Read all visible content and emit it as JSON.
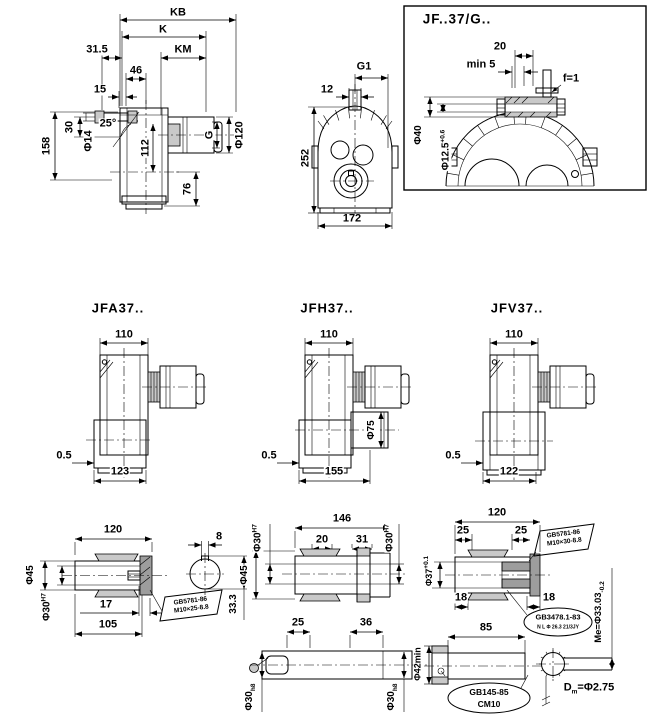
{
  "sheet": {
    "detail_box_title": "JF..37/G..",
    "top_side": {
      "kb": "KB",
      "k": "K",
      "km": "KM",
      "d315": "31.5",
      "d46": "46",
      "d15": "15",
      "a25": "25°",
      "phi14": "Φ14",
      "d30": "30",
      "d158": "158",
      "d112": "112",
      "d76": "76",
      "g": "G",
      "phi120": "Φ120"
    },
    "top_front": {
      "g1": "G1",
      "d12": "12",
      "d252": "252",
      "d172": "172"
    },
    "detail_box": {
      "d20": "20",
      "min5": "min 5",
      "f1": "f=1",
      "phi40": "Φ40",
      "phi125": "Φ12.5",
      "phi125_tol": "+0.6"
    },
    "variants": [
      {
        "label": "JFA37..",
        "top": "110",
        "left": "0.5",
        "bottom": "123"
      },
      {
        "label": "JFH37..",
        "top": "110",
        "left": "0.5",
        "bottom": "155",
        "phi75": "Φ75"
      },
      {
        "label": "JFV37..",
        "top": "110",
        "left": "0.5",
        "bottom": "122"
      }
    ],
    "shaft_left": {
      "d120": "120",
      "phi45": "Φ45",
      "phi30": "Φ30",
      "phi30_tol": "H7",
      "d17": "17",
      "d105": "105",
      "callout1": "GB5781-86",
      "callout2": "M10×25-8.8",
      "d8": "8",
      "d333": "33.3"
    },
    "shaft_mid": {
      "d146": "146",
      "d20": "20",
      "d31": "31",
      "phi30a": "Φ30",
      "phi30a_tol": "H7",
      "phi30b": "Φ30",
      "phi30b_tol": "H7",
      "phi45": "Φ45",
      "d25": "25",
      "d36": "36",
      "phi30c": "Φ30",
      "phi30c_tol": "h8",
      "phi30d": "Φ30",
      "phi30d_tol": "h8"
    },
    "shaft_right": {
      "d120": "120",
      "d25a": "25",
      "d25b": "25",
      "bolt1": "GB5781-86",
      "bolt2": "M10×30-8.8",
      "phi37": "Φ37",
      "phi37_tol": "+0.1",
      "d18a": "18",
      "d18b": "18",
      "spline1": "GB3478.1-83",
      "spline2": "N L Φ 26.3 21/3JY",
      "me": "Me=Φ33.03",
      "me_tol": "-0.2",
      "d85": "85",
      "phi42": "Φ42min",
      "center1": "GB145-85",
      "center2": "CM10",
      "dm_d": "D",
      "dm_sub": "m",
      "dm_val": "=Φ2.75"
    }
  }
}
